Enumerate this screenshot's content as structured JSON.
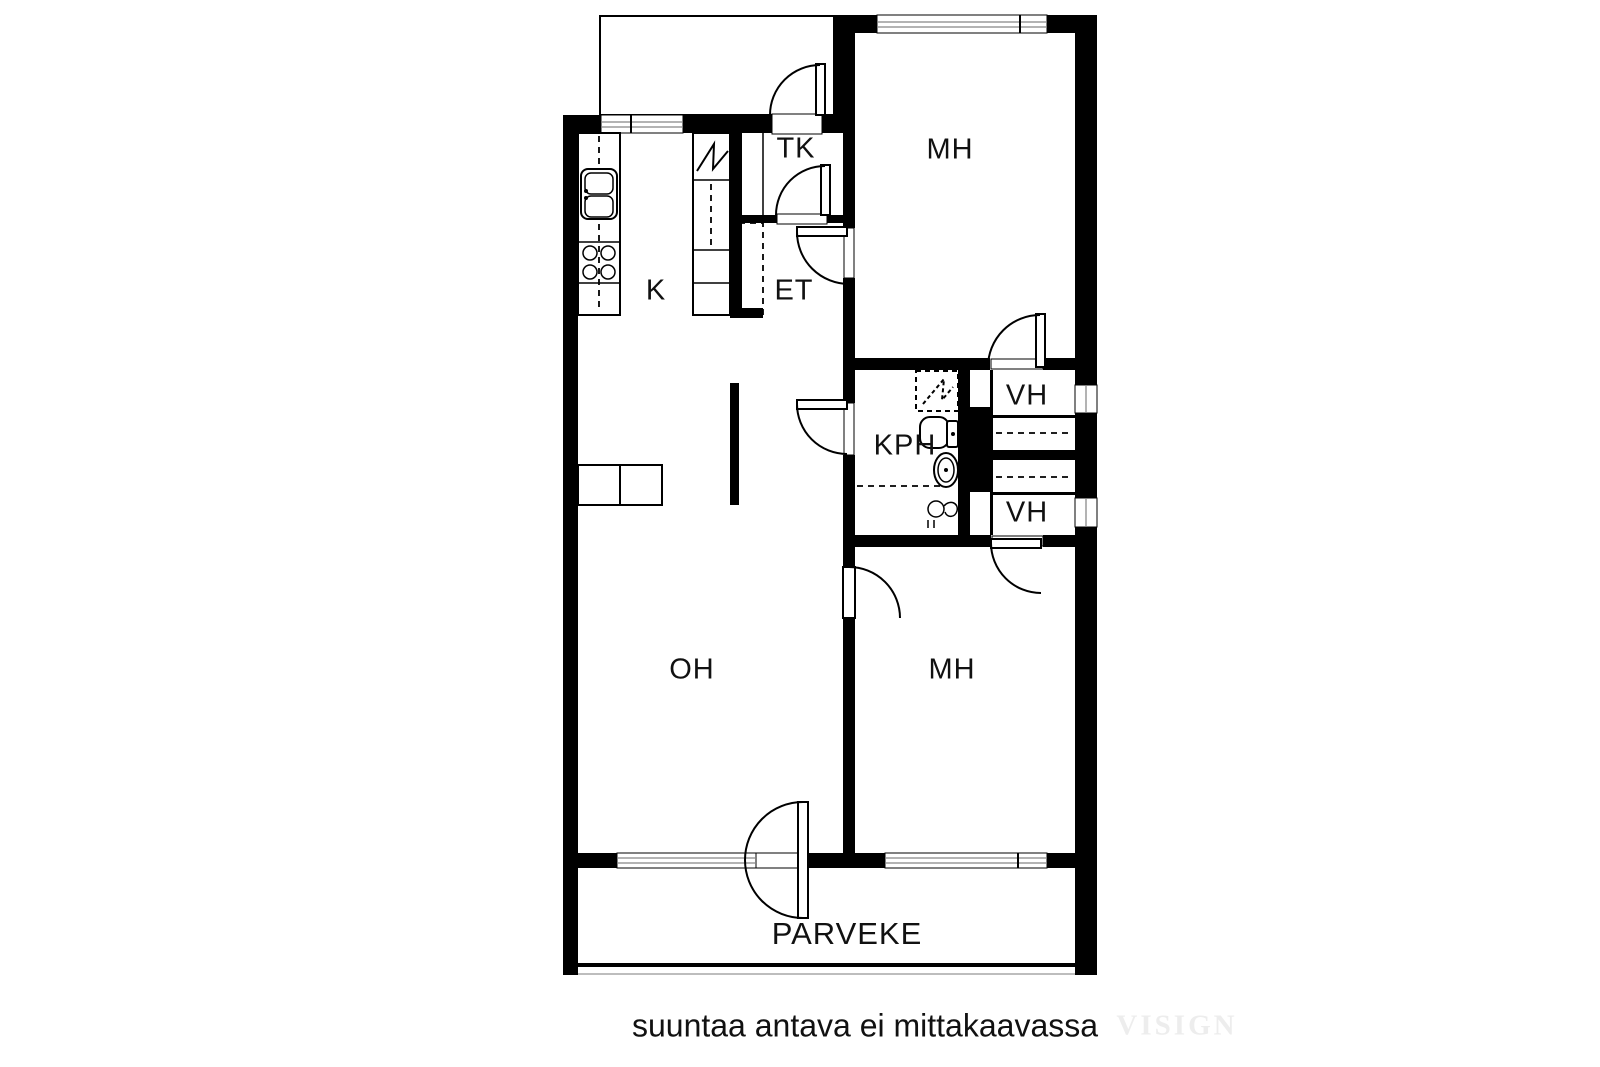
{
  "plan": {
    "rooms": [
      {
        "id": "k",
        "label": "K"
      },
      {
        "id": "tk",
        "label": "TK"
      },
      {
        "id": "et",
        "label": "ET"
      },
      {
        "id": "mh_upper",
        "label": "MH"
      },
      {
        "id": "kph",
        "label": "KPH"
      },
      {
        "id": "vh_upper",
        "label": "VH"
      },
      {
        "id": "vh_lower",
        "label": "VH"
      },
      {
        "id": "oh",
        "label": "OH"
      },
      {
        "id": "mh_lower",
        "label": "MH"
      },
      {
        "id": "parveke",
        "label": "PARVEKE"
      }
    ],
    "caption": "suuntaa antava ei mittakaavassa",
    "watermark": "VISIGN",
    "colors": {
      "wall": "#000000",
      "glazing": "#b3b3b3",
      "label": "#111111",
      "watermark": "#ededed"
    }
  }
}
